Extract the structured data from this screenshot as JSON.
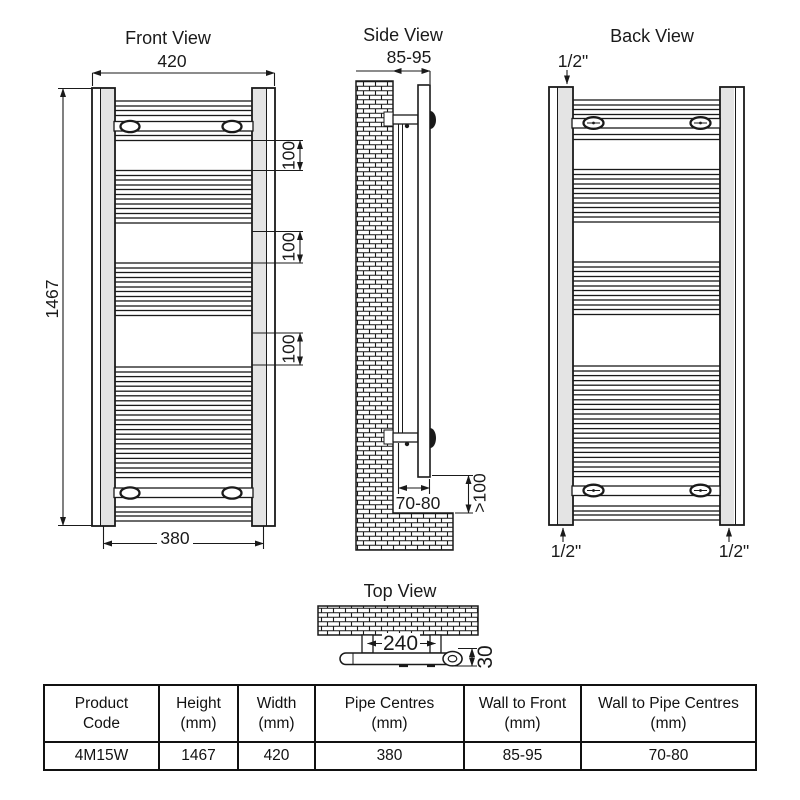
{
  "views": {
    "front": {
      "title": "Front View",
      "width_dim": "420",
      "height_dim": "1467",
      "pipe_centres_dim": "380",
      "rung_spacing_dim": "100"
    },
    "side": {
      "title": "Side View",
      "wall_to_front_dim": "85-95",
      "wall_to_pipe_dim": "70-80",
      "floor_clearance_dim": ">100"
    },
    "back": {
      "title": "Back View",
      "connection_size": "1/2\""
    },
    "top": {
      "title": "Top View",
      "bracket_centres_dim": "240",
      "depth_dim": "30"
    }
  },
  "table": {
    "headers": [
      {
        "l1": "Product",
        "l2": "Code"
      },
      {
        "l1": "Height",
        "l2": "(mm)"
      },
      {
        "l1": "Width",
        "l2": "(mm)"
      },
      {
        "l1": "Pipe Centres",
        "l2": "(mm)"
      },
      {
        "l1": "Wall to Front",
        "l2": "(mm)"
      },
      {
        "l1": "Wall to Pipe Centres",
        "l2": "(mm)"
      }
    ],
    "row": [
      "4M15W",
      "1467",
      "420",
      "380",
      "85-95",
      "70-80"
    ]
  },
  "colors": {
    "line": "#1a1a1a",
    "background": "#ffffff",
    "rail_shade": "#e4e4e4"
  }
}
